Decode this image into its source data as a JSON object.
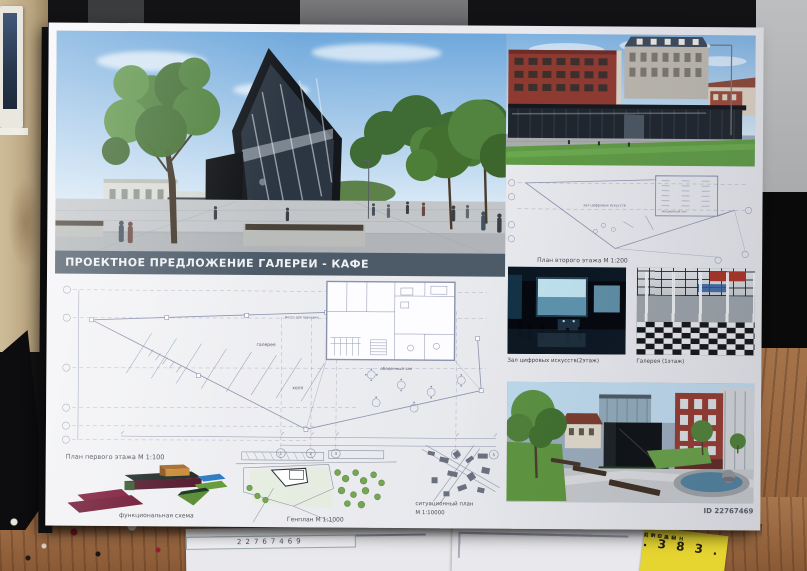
{
  "poster": {
    "title_banner": "ПРОЕКТНОЕ ПРЕДЛОЖЕНИЕ ГАЛЕРЕИ - КАФЕ",
    "id_label": "ID 22767469",
    "first_floor_plan": {
      "label": "План первого этажа М 1:100",
      "room_parking": "место для парковки",
      "room_gallery": "галерея",
      "room_hall": "холл",
      "room_dining": "обеденный зал",
      "axis": [
        "1",
        "2",
        "3",
        "4",
        "5"
      ]
    },
    "second_floor_plan": {
      "label": "План второго этажа М 1:200",
      "room_digital": "зал цифровых искусств",
      "room_lecture": "лекционный зал"
    },
    "genplan": {
      "label": "Генплан М 1:1000"
    },
    "situation_plan": {
      "label_line1": "ситуационный план",
      "label_line2": "М 1:10000"
    },
    "functional_scheme": {
      "label": "функциональная схема"
    },
    "captions": {
      "digital_hall": "Зал цифровых искусств(2этаж)",
      "gallery": "Галерея (1этаж)"
    }
  },
  "desk": {
    "paper_form_number": "22767469",
    "sticker": {
      "line1": "ДИЗАЙН",
      "line2": "СРЕДЫ",
      "number": ". 3 8 3 ."
    }
  },
  "colors": {
    "banner": "#4d5b69",
    "sticker": "#e6d531",
    "scheme_maroon": "#6d1330",
    "scheme_green": "#689b3c",
    "scheme_blue": "#2e7cc3",
    "scheme_orange": "#c98a36"
  }
}
